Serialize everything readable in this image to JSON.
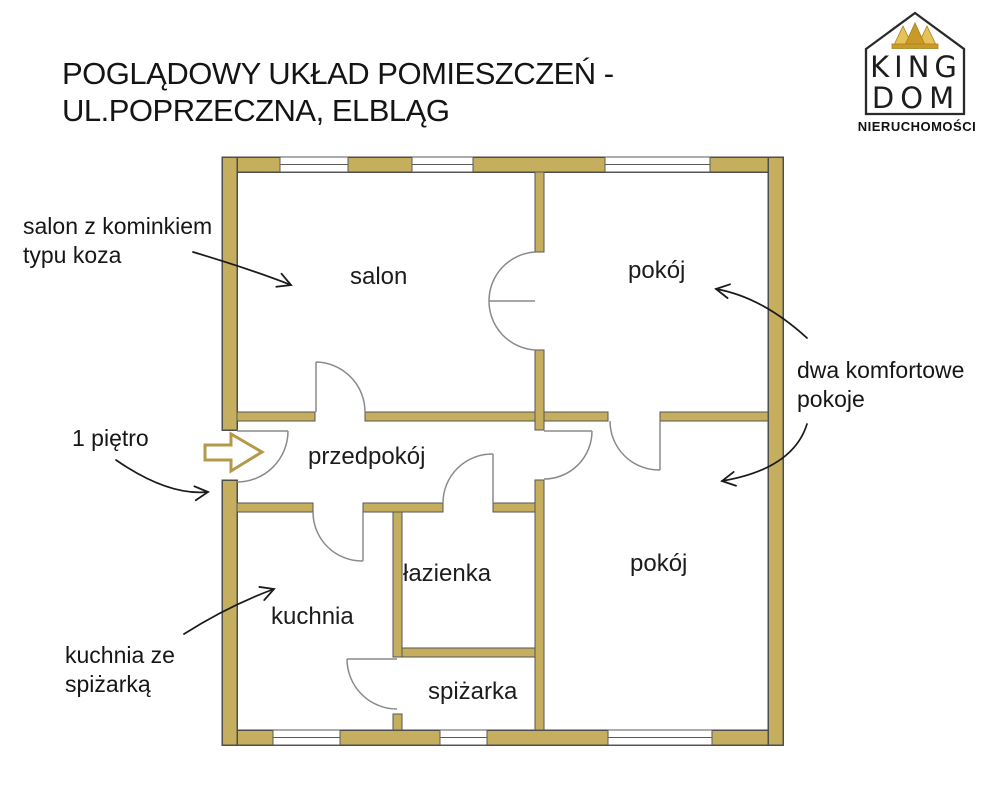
{
  "title": {
    "line1": "POGLĄDOWY UKŁAD POMIESZCZEŃ -",
    "line2": "UL.POPRZECZNA, ELBLĄG"
  },
  "logo": {
    "brand_top": "KING",
    "brand_bottom": "DOM",
    "subtitle": "NIERUCHOMOŚCI"
  },
  "rooms": {
    "salon": "salon",
    "room_top": "pokój",
    "hall": "przedpokój",
    "bathroom": "łazienka",
    "kitchen": "kuchnia",
    "pantry": "spiżarka",
    "room_bottom": "pokój"
  },
  "annotations": {
    "salon_note_line1": "salon z kominkiem",
    "salon_note_line2": "typu koza",
    "floor_note": "1 piętro",
    "kitchen_note_line1": "kuchnia ze",
    "kitchen_note_line2": "spiżarką",
    "rooms_note_line1": "dwa komfortowe",
    "rooms_note_line2": "pokoje"
  },
  "colors": {
    "wall_fill": "#c5ae5e",
    "wall_stroke": "#4d4d4d",
    "door_stroke": "#8a8a8a",
    "annotation_arrow": "#1a1a1a",
    "entrance_arrow_stroke": "#b5994a",
    "crown_gold_dark": "#c99a28",
    "crown_gold_light": "#e6c258",
    "text": "#1c1c1c"
  }
}
